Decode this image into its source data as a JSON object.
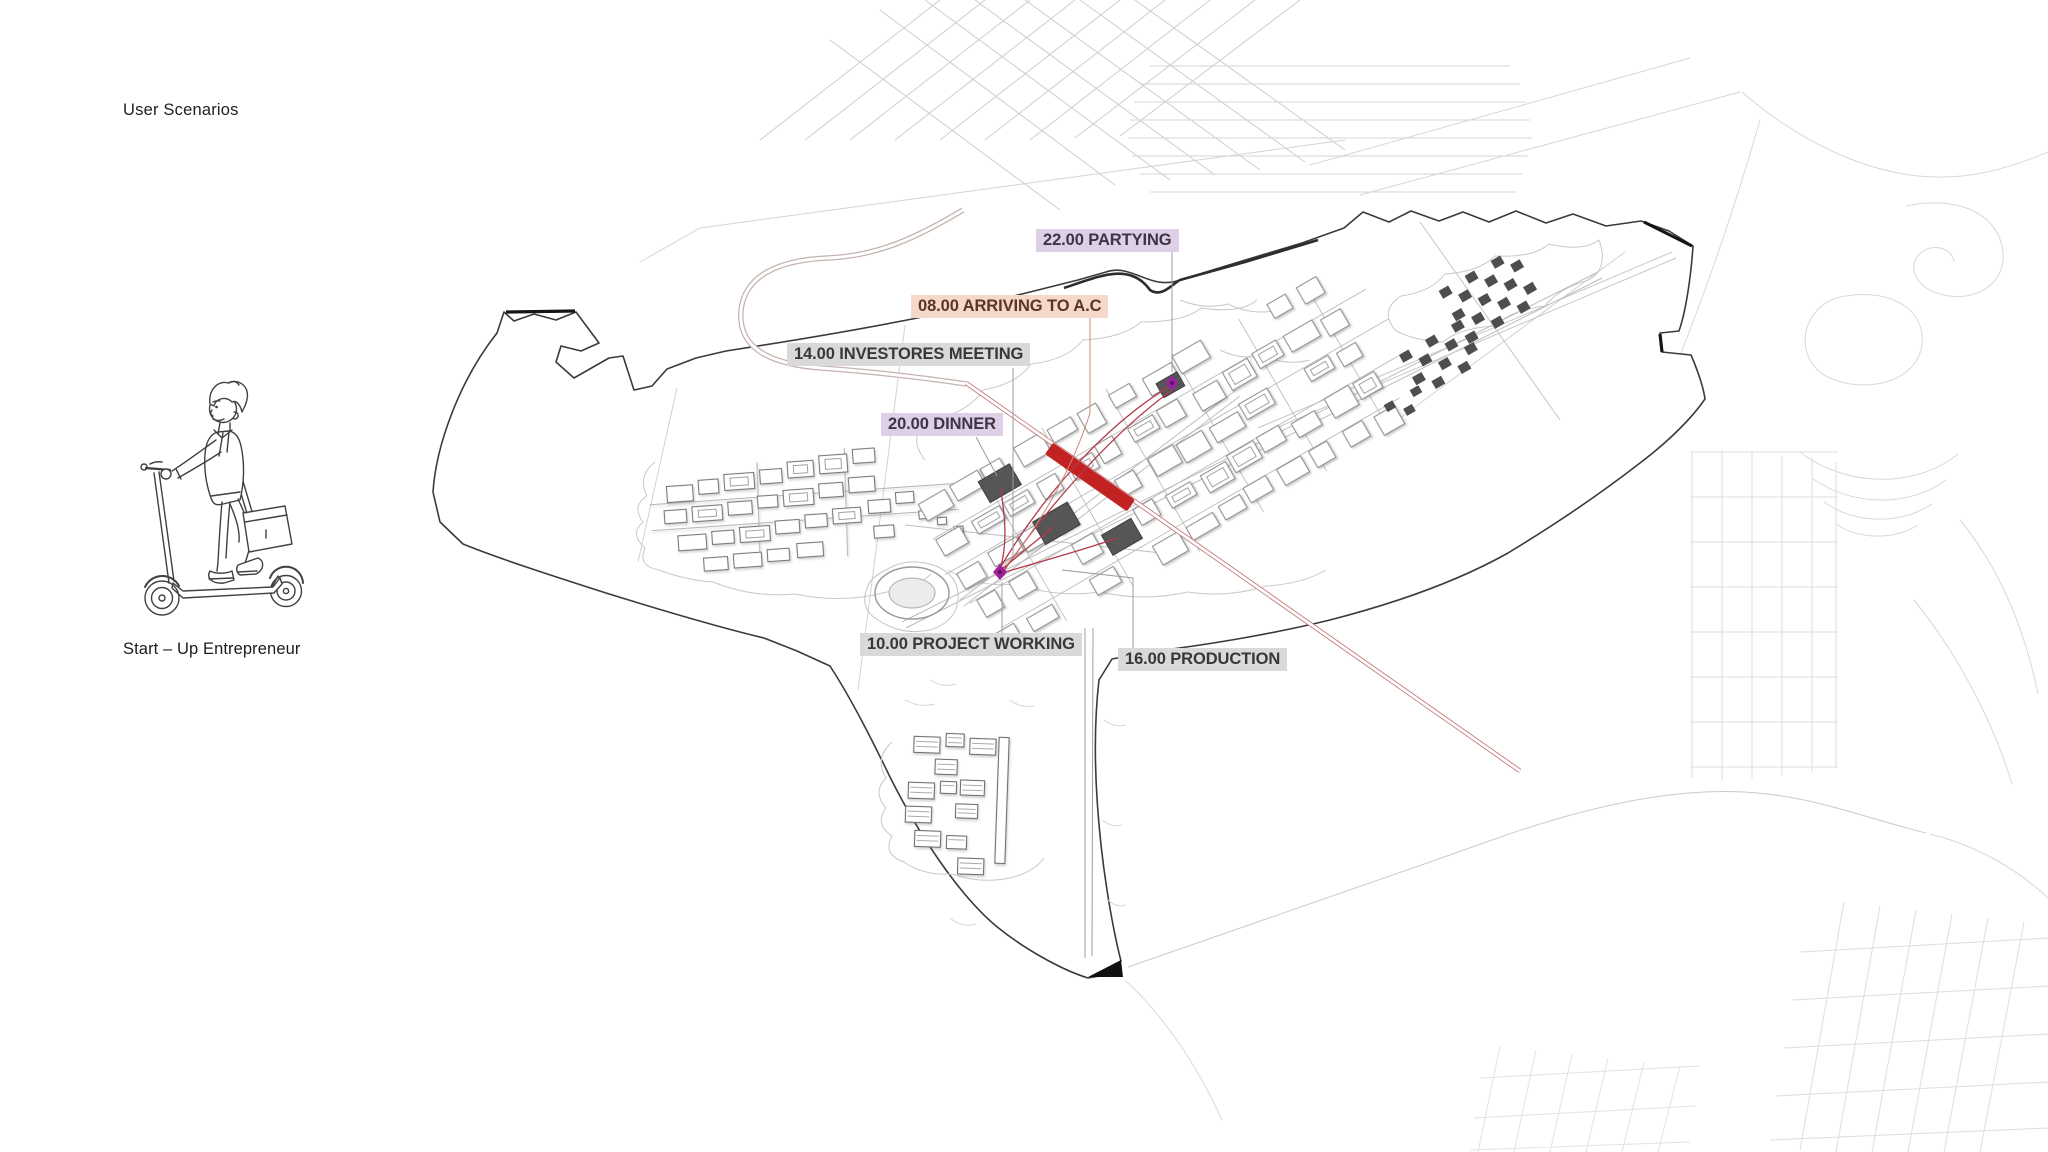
{
  "page": {
    "title": "User Scenarios",
    "background": "#ffffff"
  },
  "persona": {
    "caption": "Start – Up Entrepreneur",
    "illustration": "man-riding-kick-scooter-with-shoulder-bag"
  },
  "scenario_labels": [
    {
      "id": "arriving",
      "label": "08.00 ARRIVING TO A.C",
      "highlight": "#f4d8c9"
    },
    {
      "id": "project-working",
      "label": "10.00 PROJECT WORKING",
      "highlight": "#d9d9d9"
    },
    {
      "id": "investors-meeting",
      "label": "14.00 INVESTORES MEETING",
      "highlight": "#d9d9d9"
    },
    {
      "id": "production",
      "label": "16.00 PRODUCTION",
      "highlight": "#d9d9d9"
    },
    {
      "id": "dinner",
      "label": "20.00 DINNER",
      "highlight": "#ddd0e6"
    },
    {
      "id": "partying",
      "label": "22.00 PARTYING",
      "highlight": "#ddd0e6"
    }
  ],
  "map": {
    "description": "masterplan site drawing with scenario route",
    "colors": {
      "site_boundary": "#3a3a3a",
      "route_accent": "#b23a4a",
      "central_spine": "#c32222",
      "scenario_node": "#9a2b9a",
      "background_fabric": "#cfcfcf"
    }
  }
}
